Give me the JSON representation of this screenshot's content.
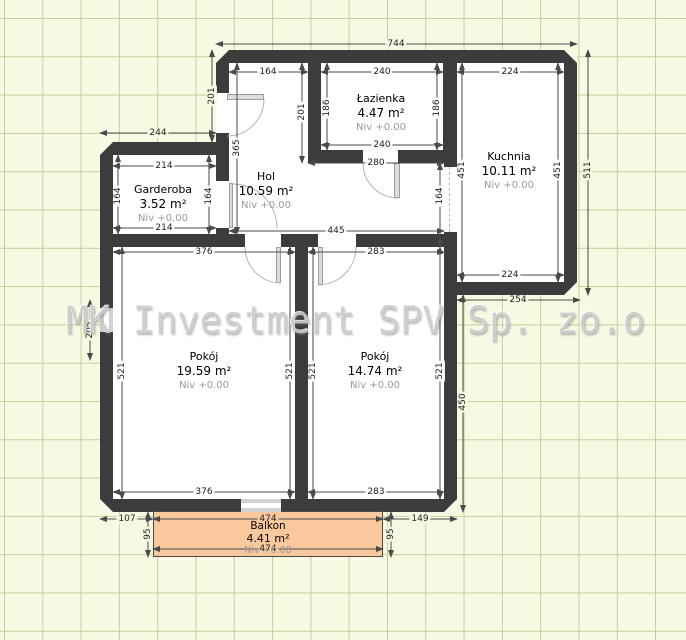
{
  "watermark": {
    "text": "MK Investment SPV Sp. zo.o"
  },
  "colors": {
    "wall": "#3c3c3c",
    "floor": "#ffffff",
    "balcony_fill": "#f9c99d",
    "grid_background": "#f7f9e3",
    "grid_line": "#c3d09b",
    "dimension_text": "#222222",
    "level_text": "#9a9a9a",
    "watermark_text": "#cbcbcb"
  },
  "rooms": [
    {
      "name": "Łazienka",
      "area": "4.47 m²",
      "level": "Niv +0.00"
    },
    {
      "name": "Kuchnia",
      "area": "10.11 m²",
      "level": "Niv +0.00"
    },
    {
      "name": "Garderoba",
      "area": "3.52 m²",
      "level": "Niv +0.00"
    },
    {
      "name": "Hol",
      "area": "10.59 m²",
      "level": "Niv +0.00"
    },
    {
      "name": "Pokój",
      "area": "19.59 m²",
      "level": "Niv +0.00"
    },
    {
      "name": "Pokój",
      "area": "14.74 m²",
      "level": "Niv +0.00"
    },
    {
      "name": "Balkon",
      "area": "4.41 m²",
      "level": "Niv +0.00"
    }
  ],
  "dimensions": [
    {
      "t": "744",
      "x": 396,
      "y": 44,
      "r": 0,
      "bg": "g"
    },
    {
      "t": "164",
      "x": 268,
      "y": 72,
      "r": 0,
      "bg": "w"
    },
    {
      "t": "240",
      "x": 382,
      "y": 72,
      "r": 0,
      "bg": "w"
    },
    {
      "t": "224",
      "x": 510,
      "y": 72,
      "r": 0,
      "bg": "w"
    },
    {
      "t": "201",
      "x": 212,
      "y": 96,
      "r": 1,
      "bg": "g"
    },
    {
      "t": "201",
      "x": 302,
      "y": 112,
      "r": 1,
      "bg": "w"
    },
    {
      "t": "186",
      "x": 327,
      "y": 108,
      "r": 1,
      "bg": "w"
    },
    {
      "t": "186",
      "x": 437,
      "y": 108,
      "r": 1,
      "bg": "w"
    },
    {
      "t": "244",
      "x": 158,
      "y": 133,
      "r": 0,
      "bg": "g"
    },
    {
      "t": "240",
      "x": 382,
      "y": 145,
      "r": 0,
      "bg": "w"
    },
    {
      "t": "365",
      "x": 237,
      "y": 148,
      "r": 1,
      "bg": "w"
    },
    {
      "t": "280",
      "x": 376,
      "y": 163,
      "r": 0,
      "bg": "w"
    },
    {
      "t": "214",
      "x": 164,
      "y": 166,
      "r": 0,
      "bg": "w"
    },
    {
      "t": "164",
      "x": 118,
      "y": 196,
      "r": 1,
      "bg": "w"
    },
    {
      "t": "164",
      "x": 209,
      "y": 196,
      "r": 1,
      "bg": "w"
    },
    {
      "t": "164",
      "x": 440,
      "y": 196,
      "r": 1,
      "bg": "w"
    },
    {
      "t": "451",
      "x": 462,
      "y": 170,
      "r": 1,
      "bg": "w"
    },
    {
      "t": "451",
      "x": 558,
      "y": 170,
      "r": 1,
      "bg": "w"
    },
    {
      "t": "511",
      "x": 588,
      "y": 170,
      "r": 1,
      "bg": "g"
    },
    {
      "t": "214",
      "x": 164,
      "y": 228,
      "r": 0,
      "bg": "w"
    },
    {
      "t": "445",
      "x": 336,
      "y": 231,
      "r": 0,
      "bg": "w"
    },
    {
      "t": "376",
      "x": 204,
      "y": 252,
      "r": 0,
      "bg": "w"
    },
    {
      "t": "283",
      "x": 376,
      "y": 252,
      "r": 0,
      "bg": "w"
    },
    {
      "t": "224",
      "x": 510,
      "y": 275,
      "r": 0,
      "bg": "w"
    },
    {
      "t": "254",
      "x": 518,
      "y": 300,
      "r": 0,
      "bg": "g"
    },
    {
      "t": "205",
      "x": 90,
      "y": 330,
      "r": 1,
      "bg": "g"
    },
    {
      "t": "521",
      "x": 122,
      "y": 371,
      "r": 1,
      "bg": "w"
    },
    {
      "t": "521",
      "x": 290,
      "y": 371,
      "r": 1,
      "bg": "w"
    },
    {
      "t": "521",
      "x": 313,
      "y": 371,
      "r": 1,
      "bg": "w"
    },
    {
      "t": "521",
      "x": 440,
      "y": 371,
      "r": 1,
      "bg": "w"
    },
    {
      "t": "450",
      "x": 463,
      "y": 402,
      "r": 1,
      "bg": "g"
    },
    {
      "t": "376",
      "x": 204,
      "y": 492,
      "r": 0,
      "bg": "w"
    },
    {
      "t": "283",
      "x": 376,
      "y": 492,
      "r": 0,
      "bg": "w"
    },
    {
      "t": "107",
      "x": 127,
      "y": 519,
      "r": 0,
      "bg": "g"
    },
    {
      "t": "474",
      "x": 268,
      "y": 519,
      "r": 0,
      "bg": "o"
    },
    {
      "t": "149",
      "x": 420,
      "y": 519,
      "r": 0,
      "bg": "g"
    },
    {
      "t": "95",
      "x": 148,
      "y": 534,
      "r": 1,
      "bg": "g"
    },
    {
      "t": "95",
      "x": 391,
      "y": 534,
      "r": 1,
      "bg": "g"
    },
    {
      "t": "474",
      "x": 268,
      "y": 549,
      "r": 0,
      "bg": "o"
    }
  ]
}
